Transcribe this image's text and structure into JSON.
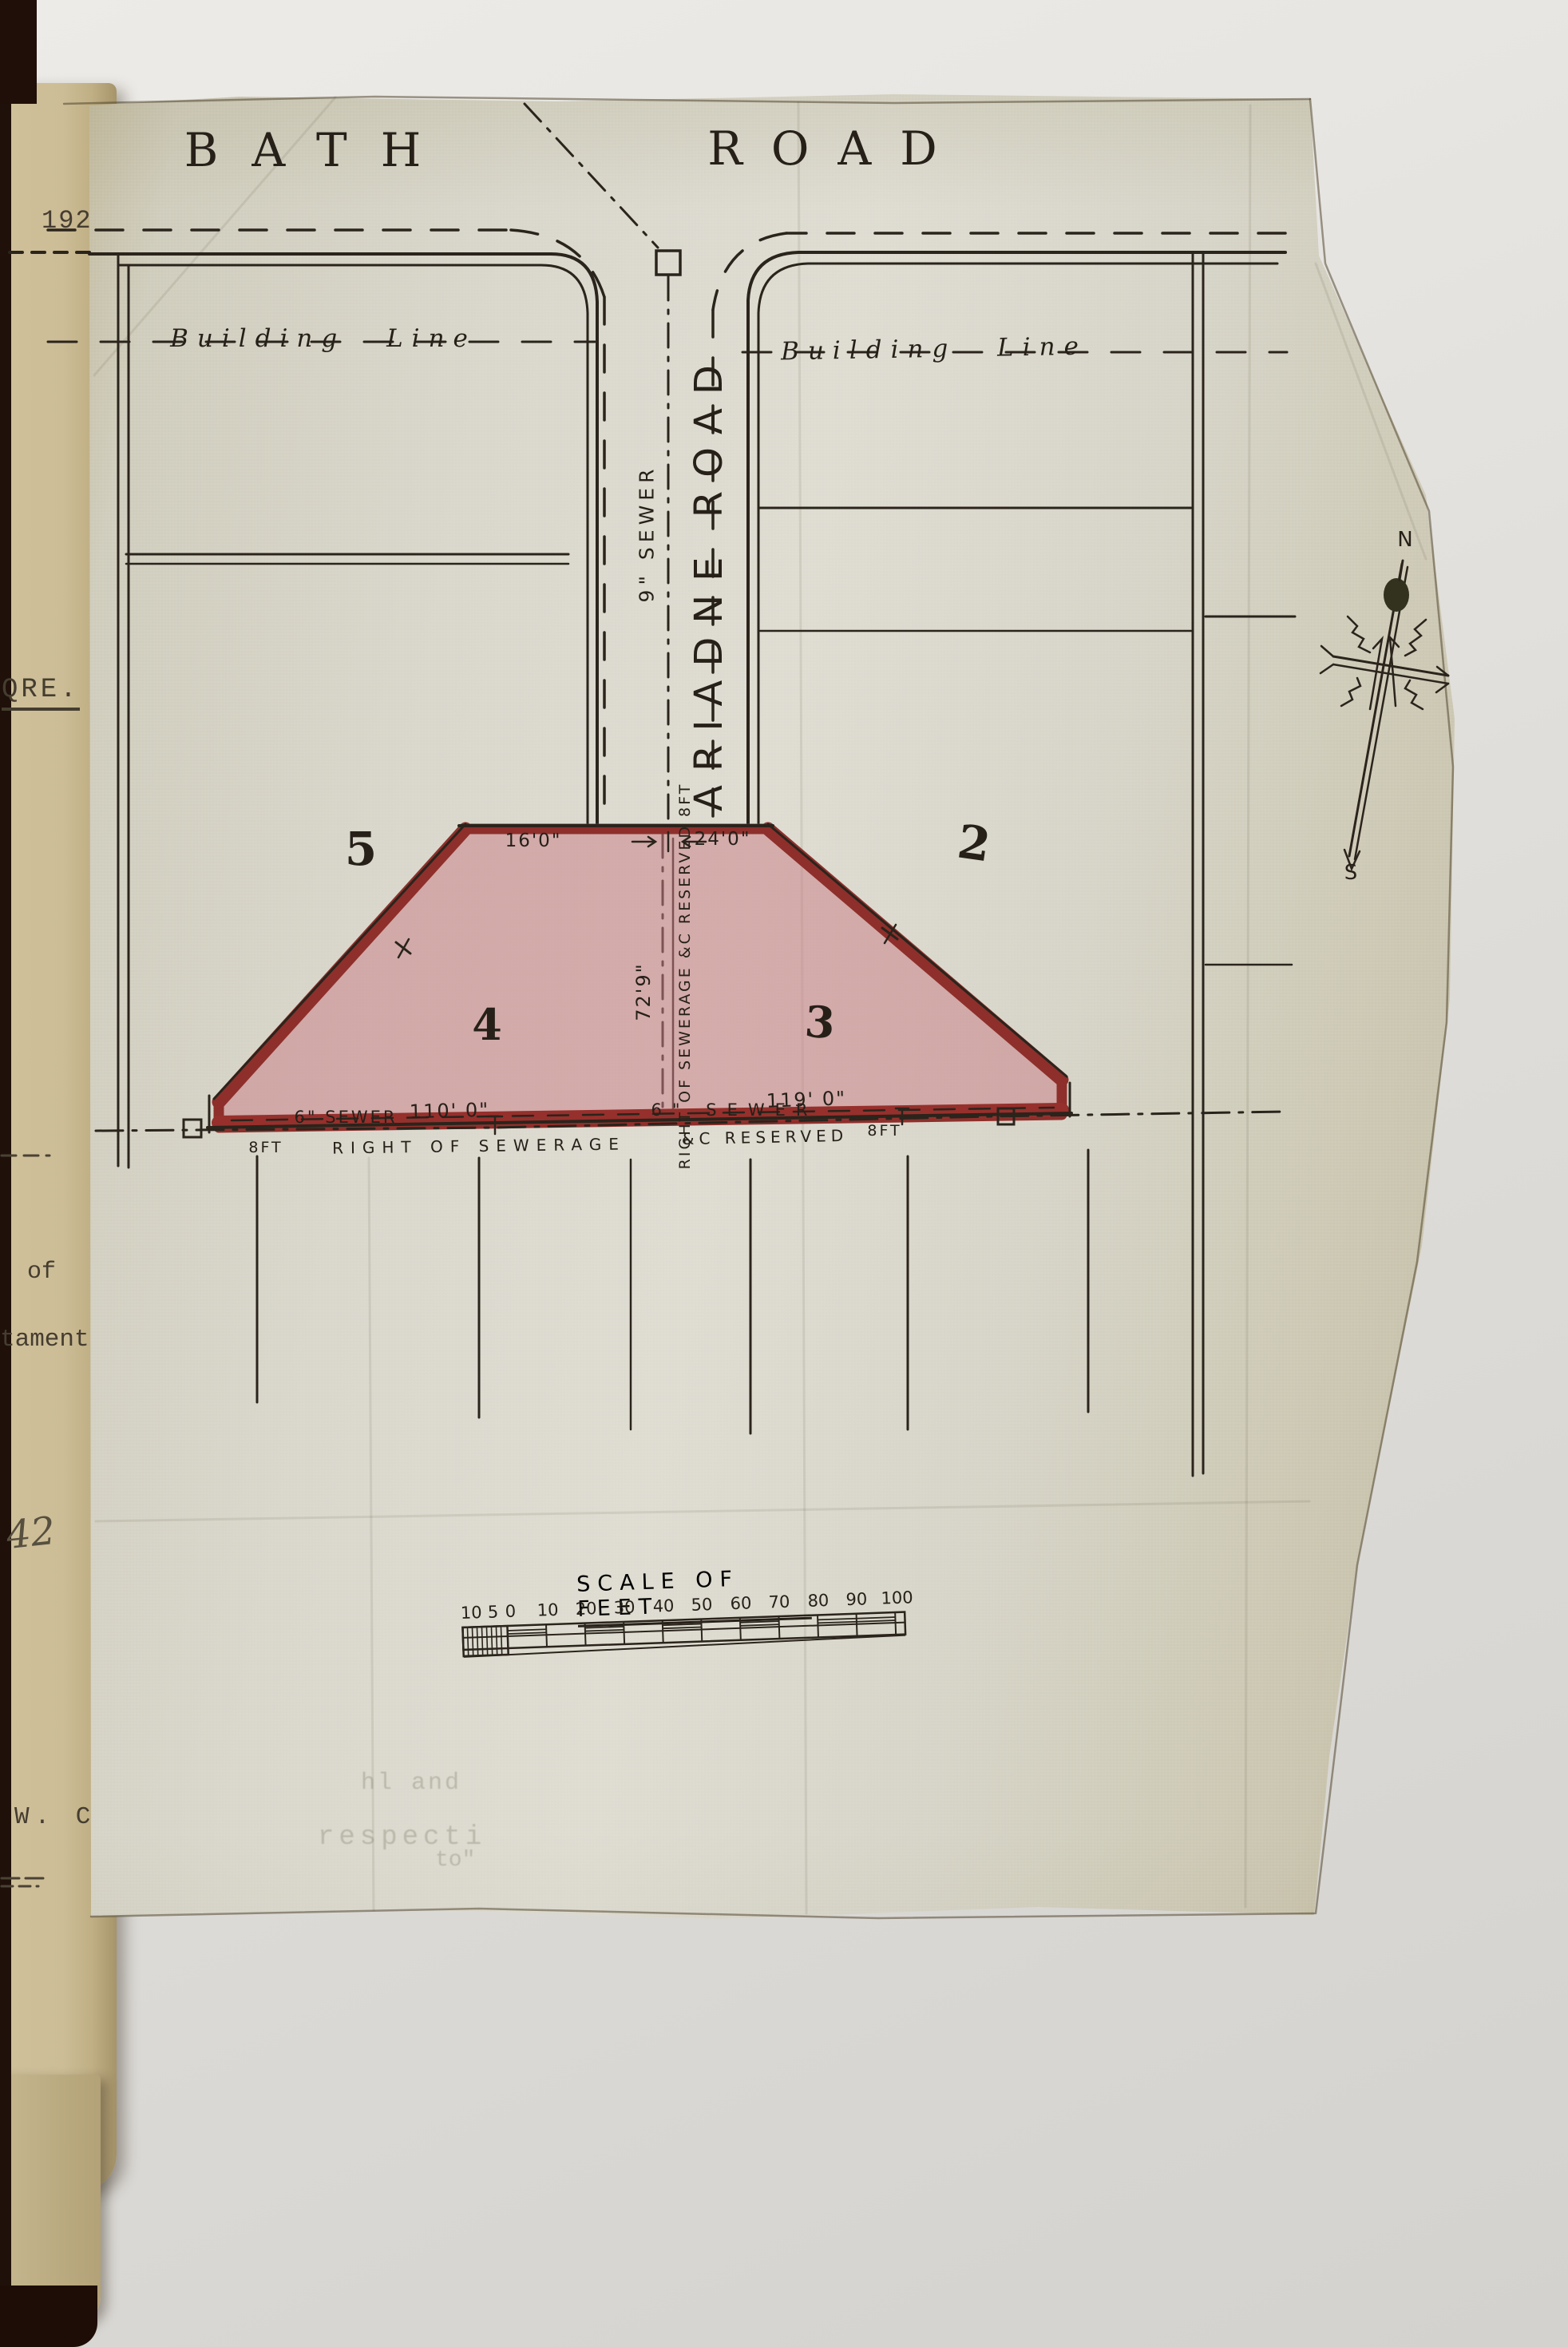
{
  "plan": {
    "bath_road": {
      "word1": "BATH",
      "word2": "ROAD"
    },
    "building_line_left": "Building Line",
    "building_line_right": "Building Line",
    "ariadne_road": "ARIADNE ROAD",
    "sewer_9": "9\" SEWER",
    "plots": {
      "p5": "5",
      "p2": "2",
      "p4": "4",
      "p3": "3"
    },
    "dims": {
      "top_left": "16'0\"",
      "top_right": "24'0\"",
      "centre": "72'9\"",
      "bottom_left": "110' 0\"",
      "bottom_right": "119' 0\""
    },
    "easement_vertical": "RIGHT OF SEWERAGE &C RESERVED 8FT",
    "sewer_6_left": "6\" SEWER",
    "sewer_6_right": "6\" SEWER",
    "easement_bottom": {
      "left_8ft": "8FT",
      "part_mid": "RIGHT OF SEWERAGE",
      "part_amp": "&C RESERVED",
      "right_8ft": "8FT"
    },
    "compass": {
      "north": "N",
      "south": "S"
    },
    "scale_bar": {
      "title": "SCALE OF FEET",
      "sub_labels": [
        "10",
        "5",
        "0"
      ],
      "labels": [
        "10",
        "20",
        "30",
        "40",
        "50",
        "60",
        "70",
        "80",
        "90",
        "100"
      ]
    }
  },
  "margin_page": {
    "ref_192": "192",
    "qre": "QRE.",
    "word_of": "of",
    "word_taments": "taments",
    "hand_42": "42",
    "wc": "W. C."
  },
  "ghost_text": {
    "line1": "hl and",
    "line2": "respecti",
    "line3": "to\""
  },
  "colors": {
    "plot_fill": "#c97f87",
    "plot_outline": "#8e2f2b",
    "ink": "#2a241c",
    "linen": "#d6d4c8",
    "tan_page": "#c9ba93",
    "backing_paper": "#e3e1dd",
    "cover": "#241208"
  }
}
